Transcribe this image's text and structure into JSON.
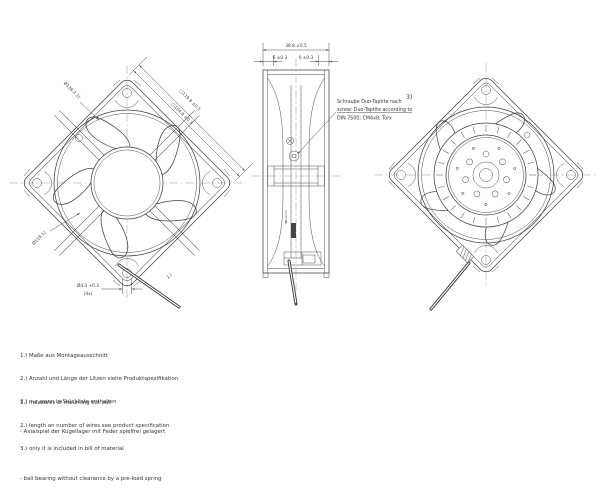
{
  "front_view": {
    "dim_square_outer": "□119.8 ±0.5",
    "dim_hole_pitch": "□104.8 ±0.3",
    "dim_cutout_top": "Ø126.2 1)",
    "dim_cutout_bottom": "Ø118 1)",
    "dim_mount_hole": "Ø4.3 +0.3",
    "dim_mount_hole_qty": "(4x)",
    "wire_note_ref": "2.)"
  },
  "side_view": {
    "dim_depth": "38.8 ±0.5",
    "dim_flange_left": "6 ±0.3",
    "dim_flange_right": "6 ±0.3"
  },
  "screw_note": {
    "ref": "3)",
    "de": "Schraube Duo-Taptite nach",
    "en": "screw: Duo-Taptite according to",
    "spec": "DIN 7500; CM4x8; Torx"
  },
  "notes_de": [
    "1.) Maße aus Montageausschnitt",
    "2.) Anzahl und Länge der Litzen siehe Produktspezifikation",
    "3.) nur wenn in Stückliste enthalten",
    "- Axialspiel der Kugellager mit Feder spielfrei gelagert"
  ],
  "notes_en": [
    "1.) measures of mounting cut out",
    "2.) length an number of wires see product specification",
    "3.) only it is included in bill of material",
    "- ball bearing without clearance by a pre-load spring"
  ],
  "colors": {
    "line": "#3f3f3f",
    "text": "#343434",
    "centerline": "#8f8f8f",
    "background": "#ffffff"
  }
}
